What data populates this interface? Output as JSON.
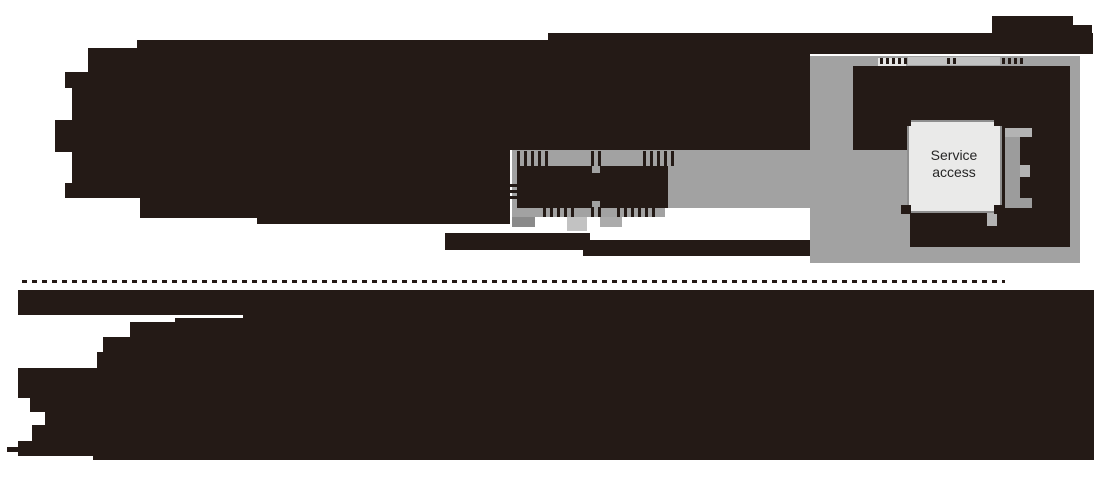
{
  "figure": {
    "kind": "floor-plan-diagram",
    "description": "Venue floor plan with dark building masses, gray circulation corridors and a service access room"
  },
  "labels": {
    "service_line1": "Service",
    "service_line2": "access"
  },
  "colors": {
    "background": "#ffffff",
    "building": "#241a16",
    "circulation": "#a2a2a2",
    "circulation_dim": "#8a8a8a",
    "circulation_mid": "#ababab",
    "circulation_light": "#c2c2c2",
    "fixture_gray": "#9c9c9c",
    "fixture_light": "#b3b3b3",
    "doorway_fill": "#e6e6e5",
    "room_fill": "#eaeae9",
    "room_border": "#8f8f8f",
    "label_text": "#262626"
  }
}
